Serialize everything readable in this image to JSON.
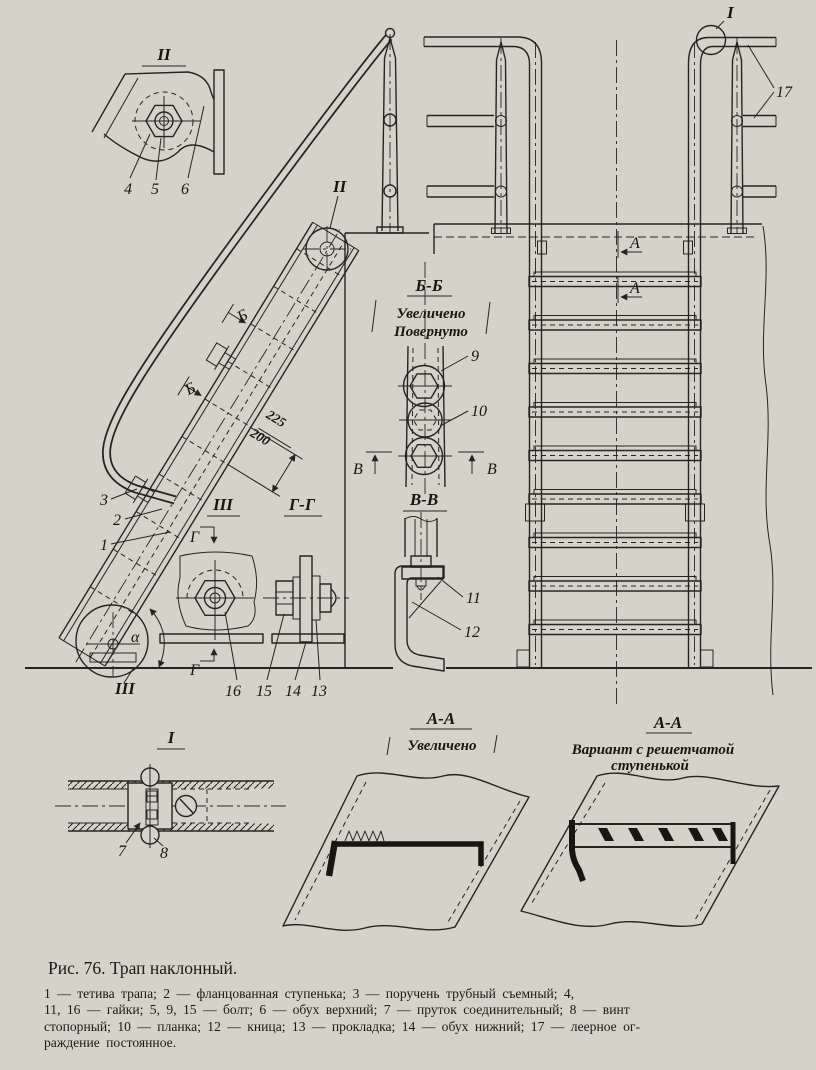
{
  "colors": {
    "paper": "#d5d3c9",
    "ink": "#26241f"
  },
  "caption": {
    "title": "Рис. 76. Трап наклонный.",
    "legend_lines": [
      "1 — тетива трапа; 2 — фланцованная ступенька; 3 — поручень трубный съемный; 4,",
      "11, 16 — гайки; 5, 9, 15 — болт; 6 — обух верхний; 7 — пруток соединительный; 8 — винт",
      "стопорный; 10 — планка; 12 — кница; 13 — прокладка; 14 — обух нижний; 17 — леерное ог-",
      "раждение постоянное."
    ]
  },
  "views": {
    "detail_1": {
      "title": "I"
    },
    "detail_2": {
      "title": "II"
    },
    "detail_3": {
      "title": "III"
    },
    "section_bb": {
      "title": "Б-Б",
      "note1": "Увеличено",
      "note2": "Повернуто"
    },
    "section_vv": {
      "title": "В-В"
    },
    "section_gg": {
      "title": "Г-Г"
    },
    "section_aa": {
      "title": "А-А",
      "note": "Увеличено"
    },
    "section_aa_variant": {
      "title": "А-А",
      "note1": "Вариант с решетчатой",
      "note2": "ступенькой"
    }
  },
  "marks": {
    "a": "А",
    "b": "Б",
    "v": "В",
    "g": "Г",
    "alpha": "α",
    "callout_1": "I",
    "callout_2": "II",
    "callout_3": "III"
  },
  "dimensions": {
    "step_pitch_min": "200",
    "step_pitch_max": "225"
  },
  "parts": {
    "n1": "1",
    "n2": "2",
    "n3": "3",
    "n4": "4",
    "n5": "5",
    "n6": "6",
    "n7": "7",
    "n8": "8",
    "n9": "9",
    "n10": "10",
    "n11": "11",
    "n12": "12",
    "n13": "13",
    "n14": "14",
    "n15": "15",
    "n16": "16",
    "n17": "17"
  }
}
